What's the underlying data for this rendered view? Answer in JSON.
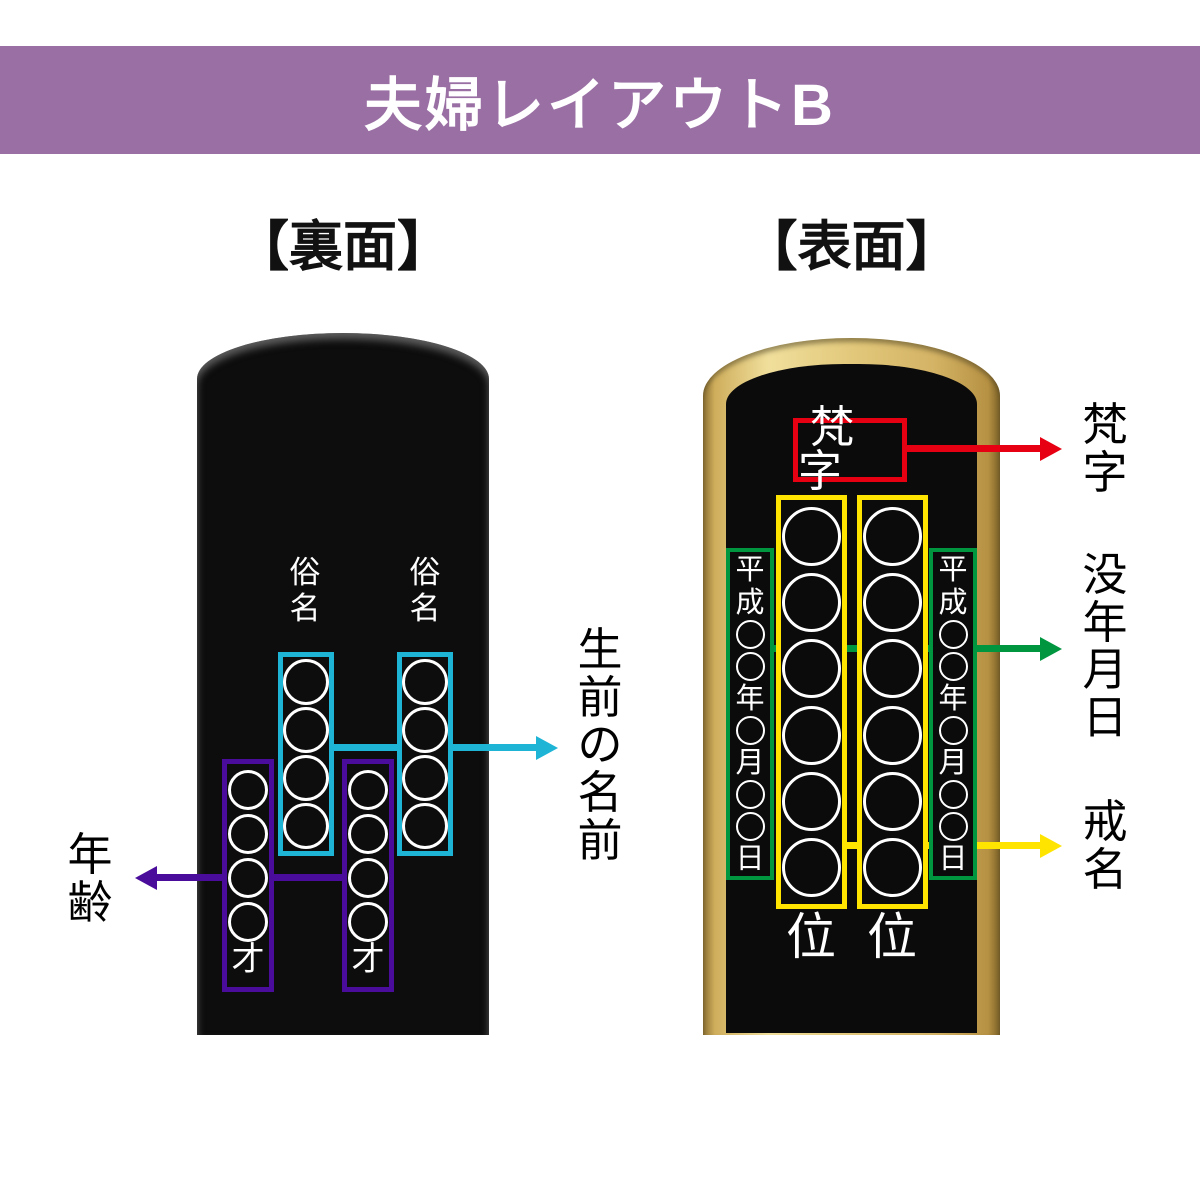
{
  "header": {
    "title": "夫婦レイアウトB",
    "bg_color": "#9a6fa4"
  },
  "sections": {
    "back_label": "【裏面】",
    "front_label": "【表面】"
  },
  "back_tablet": {
    "zokumyo_column_label": "俗名",
    "name_box": {
      "circles": 4,
      "border_color": "#1db4d6"
    },
    "age_box": {
      "circles": 4,
      "suffix": "才",
      "border_color": "#4a0d9b"
    },
    "annotations": {
      "name": "生前の名前",
      "age": "年齢"
    }
  },
  "front_tablet": {
    "bonji_box": {
      "label": "梵字",
      "border_color": "#e60012"
    },
    "kaimyo_box": {
      "circles": 6,
      "border_color": "#ffe400",
      "rank_label": "位"
    },
    "date_box": {
      "text": "平成○○年○月○○日",
      "border_color": "#009640"
    },
    "annotations": {
      "bonji": "梵字",
      "death_date": "没年月日",
      "kaimyo": "戒名"
    }
  }
}
